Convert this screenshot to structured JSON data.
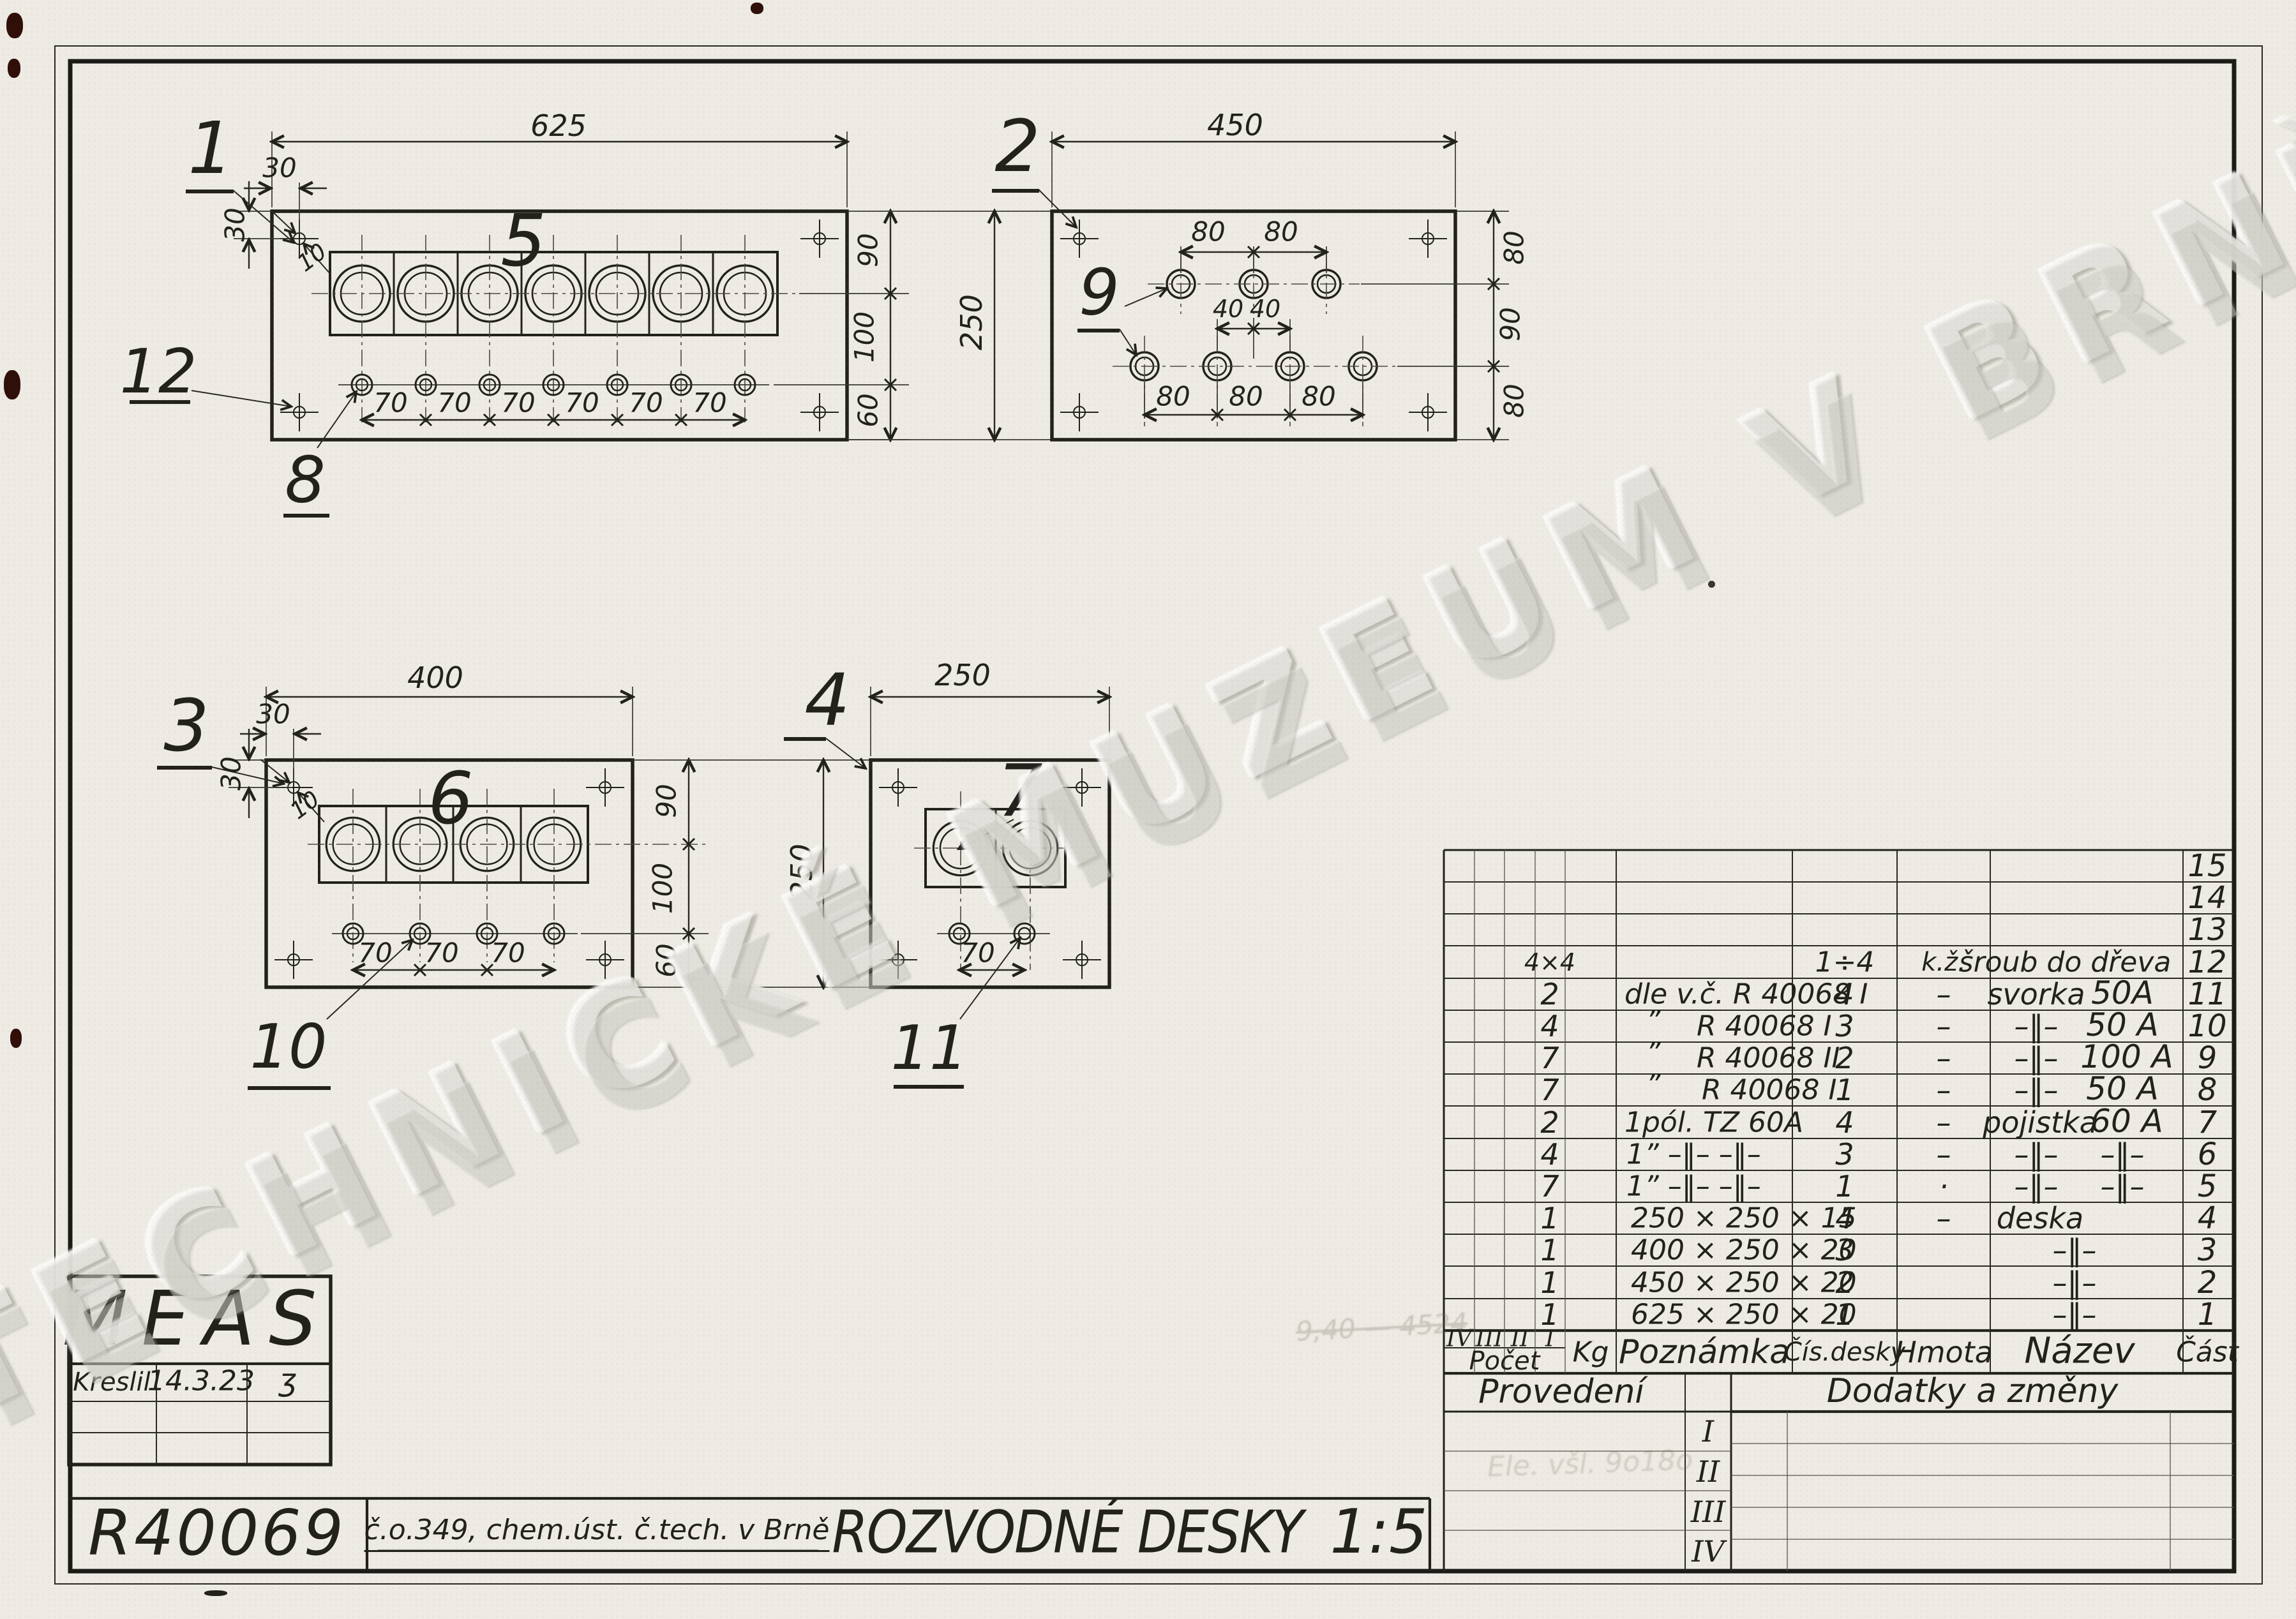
{
  "watermark": "TECHNICKÉ MUZEUM V BRNĚ",
  "plates": {
    "p1": {
      "label": "1",
      "fuse": "5",
      "hole": "8",
      "corner": "12",
      "w": "625",
      "oh": "30",
      "ov": "30",
      "dia": "10",
      "s": [
        "70",
        "70",
        "70",
        "70",
        "70",
        "70"
      ],
      "v": [
        "90",
        "100",
        "60"
      ],
      "h": "250"
    },
    "p2": {
      "label": "2",
      "hole": "9",
      "w": "450",
      "t": [
        "80",
        "80"
      ],
      "m": [
        "40",
        "40"
      ],
      "b": [
        "80",
        "80",
        "80"
      ],
      "v": [
        "80",
        "90",
        "80"
      ]
    },
    "p3": {
      "label": "3",
      "fuse": "6",
      "hole": "10",
      "w": "400",
      "oh": "30",
      "ov": "30",
      "dia": "10",
      "s": [
        "70",
        "70",
        "70"
      ],
      "v": [
        "90",
        "100",
        "60"
      ],
      "h": "250"
    },
    "p4": {
      "label": "4",
      "fuse": "7",
      "hole": "11",
      "w": "250",
      "s": "70"
    }
  },
  "table": {
    "romans": [
      "IV",
      "III",
      "II",
      "I"
    ],
    "headers": {
      "pocet": "Počet",
      "kg": "Kg",
      "poznamka": "Poznámka",
      "cis": "Čís.desky",
      "hmota": "Hmota",
      "nazev": "Název",
      "cast": "Část"
    },
    "rows": [
      {
        "part": "15"
      },
      {
        "part": "14"
      },
      {
        "part": "13"
      },
      {
        "part": "12",
        "qty": "4×4",
        "desk": "1÷4",
        "hm": "k.ž.",
        "n1": "šroub  do  dřeva"
      },
      {
        "part": "11",
        "qty": "2",
        "note": "dle v.č.  R 40068 I",
        "desk": "4",
        "hm": "–",
        "n1": "svorka",
        "n2": "50A"
      },
      {
        "part": "10",
        "qty": "4",
        "q": "”",
        "note": "R 40068 I",
        "desk": "3",
        "hm": "–",
        "n1": "–‖–",
        "n2": "50 A"
      },
      {
        "part": "9",
        "qty": "7",
        "q": "”",
        "note": "R 40068 II",
        "desk": "2",
        "hm": "–",
        "n1": "–‖–",
        "n2": "100 A"
      },
      {
        "part": "8",
        "qty": "7",
        "q": "”",
        "note": "R 40068 I",
        "desk": "1",
        "hm": "–",
        "n1": "–‖–",
        "n2": "50 A"
      },
      {
        "part": "7",
        "qty": "2",
        "note": "1pól.  TZ 60A",
        "desk": "4",
        "hm": "–",
        "n1": "pojistka",
        "n2": "60 A"
      },
      {
        "part": "6",
        "qty": "4",
        "note": "1”  –‖–  –‖–",
        "desk": "3",
        "hm": "–",
        "n1": "–‖–",
        "n2": "–‖–"
      },
      {
        "part": "5",
        "qty": "7",
        "note": "1”  –‖–  –‖–",
        "desk": "1",
        "hm": "·",
        "n1": "–‖–",
        "n2": "–‖–"
      },
      {
        "part": "4",
        "qty": "1",
        "note": "250 × 250 × 15",
        "desk": "4",
        "hm": "–",
        "n1": "deska"
      },
      {
        "part": "3",
        "qty": "1",
        "note": "400 × 250 × 20",
        "desk": "3",
        "n1": "–‖–"
      },
      {
        "part": "2",
        "qty": "1",
        "note": "450 × 250 × 20",
        "desk": "2",
        "n1": "–‖–"
      },
      {
        "part": "1",
        "qty": "1",
        "note": "625 × 250 × 20",
        "desk": "1",
        "n1": "–‖–"
      }
    ]
  },
  "provedeni": {
    "title": "Provedení",
    "rows": [
      "I",
      "II",
      "III",
      "IV"
    ]
  },
  "dodatky": {
    "title": "Dodatky  a  změny"
  },
  "meas": {
    "name": "MEAS",
    "kreslil": "Kreslil",
    "date": "14.3.23",
    "sig": "ʒ"
  },
  "footer": {
    "no": "R40069",
    "org": "č.o.349, chem.úst. č.tech.  v Brně",
    "title": "ROZVODNÉ  DESKY",
    "scale": "1:5"
  },
  "pencil": {
    "n1": "9,40 — 4524",
    "n2": "Ele. všl.  9o18o"
  }
}
